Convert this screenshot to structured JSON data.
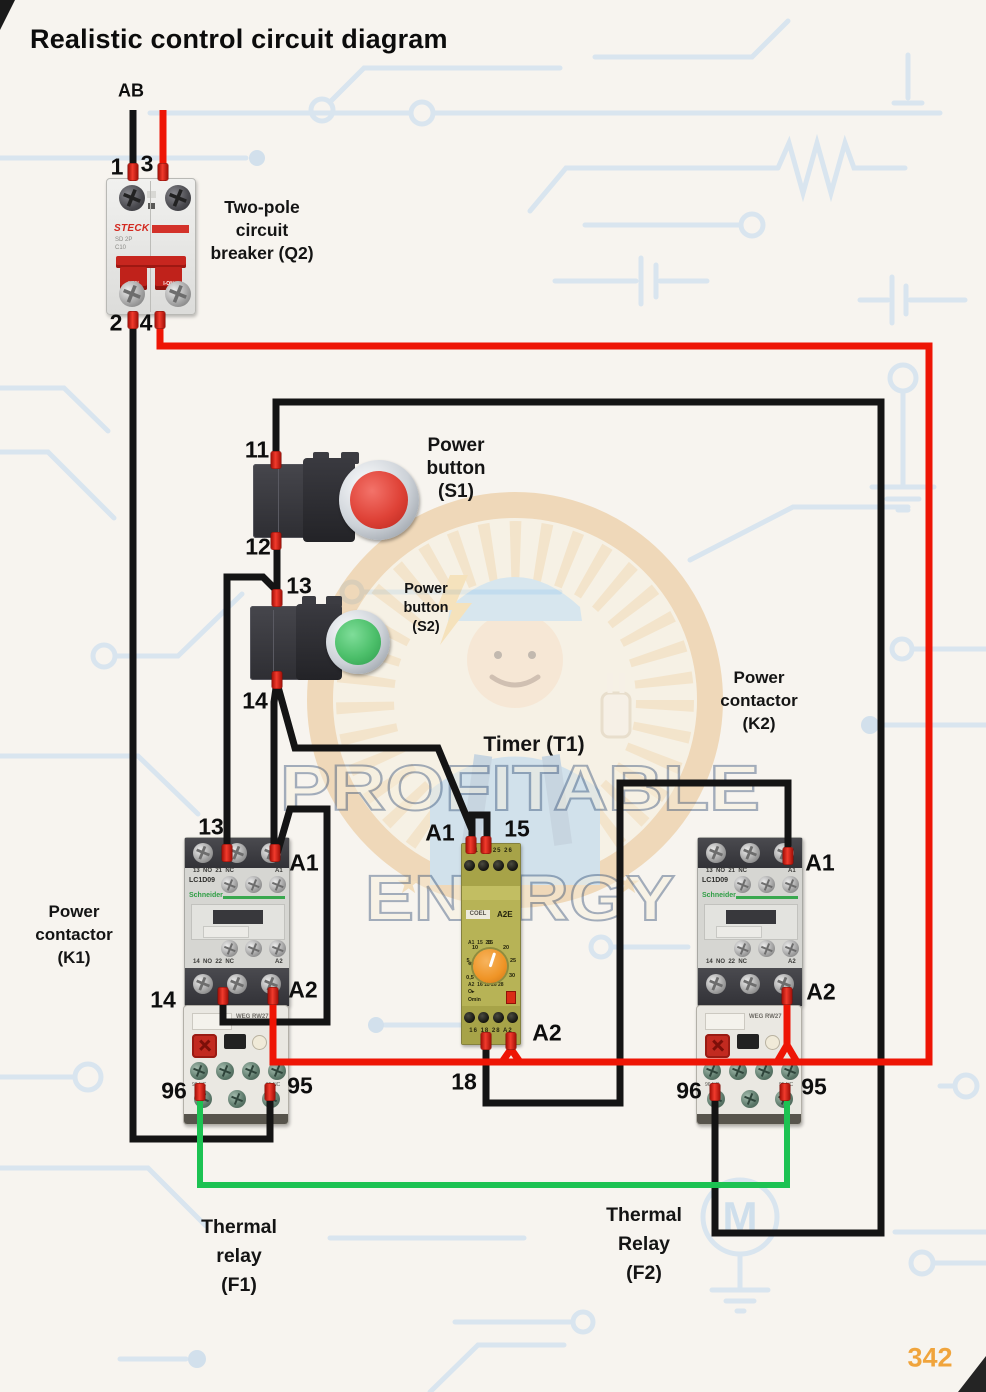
{
  "title": "Realistic control circuit diagram",
  "page_number": "342",
  "source_label": "AB",
  "watermark": {
    "line1": "PROFITABLE",
    "line2": "ENERGY"
  },
  "background": {
    "motor_label": "M"
  },
  "breaker": {
    "caption": [
      "Two-pole",
      "circuit",
      "breaker (Q2)"
    ],
    "brand": "STECK",
    "sub": "SD 2P",
    "rating": "C10",
    "handle_label": "I-ON",
    "wire_labels": {
      "t1": "1",
      "t3": "3",
      "t2": "2",
      "t4": "4"
    }
  },
  "s1": {
    "caption": [
      "Power",
      "button",
      "(S1)"
    ],
    "wire_labels": {
      "top": "11",
      "bottom": "12"
    }
  },
  "s2": {
    "caption": [
      "Power",
      "button",
      "(S2)"
    ],
    "wire_labels": {
      "top": "13",
      "bottom": "14"
    }
  },
  "timer": {
    "caption": "Timer (T1)",
    "brand": "COEL",
    "model": "A2E",
    "top_terminals": "A1 15 25 26",
    "bottom_terminals": "16 18 28 A2",
    "diag_row1": "A1  15  25",
    "diag_row2": "A2  16 18 26 28",
    "dial_labels": [
      "0,5",
      "5",
      "10",
      "15",
      "20",
      "25",
      "30"
    ],
    "ind1": "O▸",
    "ind2": "Omin",
    "wire_labels": {
      "a1": "A1",
      "t15": "15",
      "t18": "18",
      "a2": "A2"
    }
  },
  "k1": {
    "caption": [
      "Power",
      "contactor",
      "(K1)"
    ],
    "model": "LC1D09",
    "brand": "Schneider",
    "aux_top": "13  NO  21  NC",
    "aux_top_right": "A1",
    "aux_bottom": "14  NO  22  NC",
    "aux_bottom_right": "A2",
    "power_top": "1L1   3L2   5L3",
    "power_bottom": "2T1   4T2   6T3",
    "wire_labels": {
      "t13": "13",
      "a1": "A1",
      "t14": "14",
      "a2": "A2"
    }
  },
  "k2": {
    "caption": [
      "Power",
      "contactor",
      "(K2)"
    ],
    "model": "LC1D09",
    "brand": "Schneider",
    "aux_top": "13  NO  21  NC",
    "aux_top_right": "A1",
    "aux_bottom": "14  NO  22  NC",
    "aux_bottom_right": "A2",
    "power_top": "1L1   3L2   5L3",
    "power_bottom": "2T1   4T2   6T3",
    "wire_labels": {
      "a1": "A1",
      "a2": "A2"
    }
  },
  "f1": {
    "caption": [
      "Thermal",
      "relay",
      "(F1)"
    ],
    "brand": "WEG RW27",
    "screw_labels_left": "96 NC",
    "screw_labels_right": "95 NC",
    "wire_labels": {
      "t96": "96",
      "t95": "95"
    }
  },
  "f2": {
    "caption": [
      "Thermal",
      "Relay",
      "(F2)"
    ],
    "brand": "WEG RW27",
    "screw_labels_left": "96 NC",
    "screw_labels_right": "95 NC",
    "wire_labels": {
      "t96": "96",
      "t95": "95"
    }
  }
}
